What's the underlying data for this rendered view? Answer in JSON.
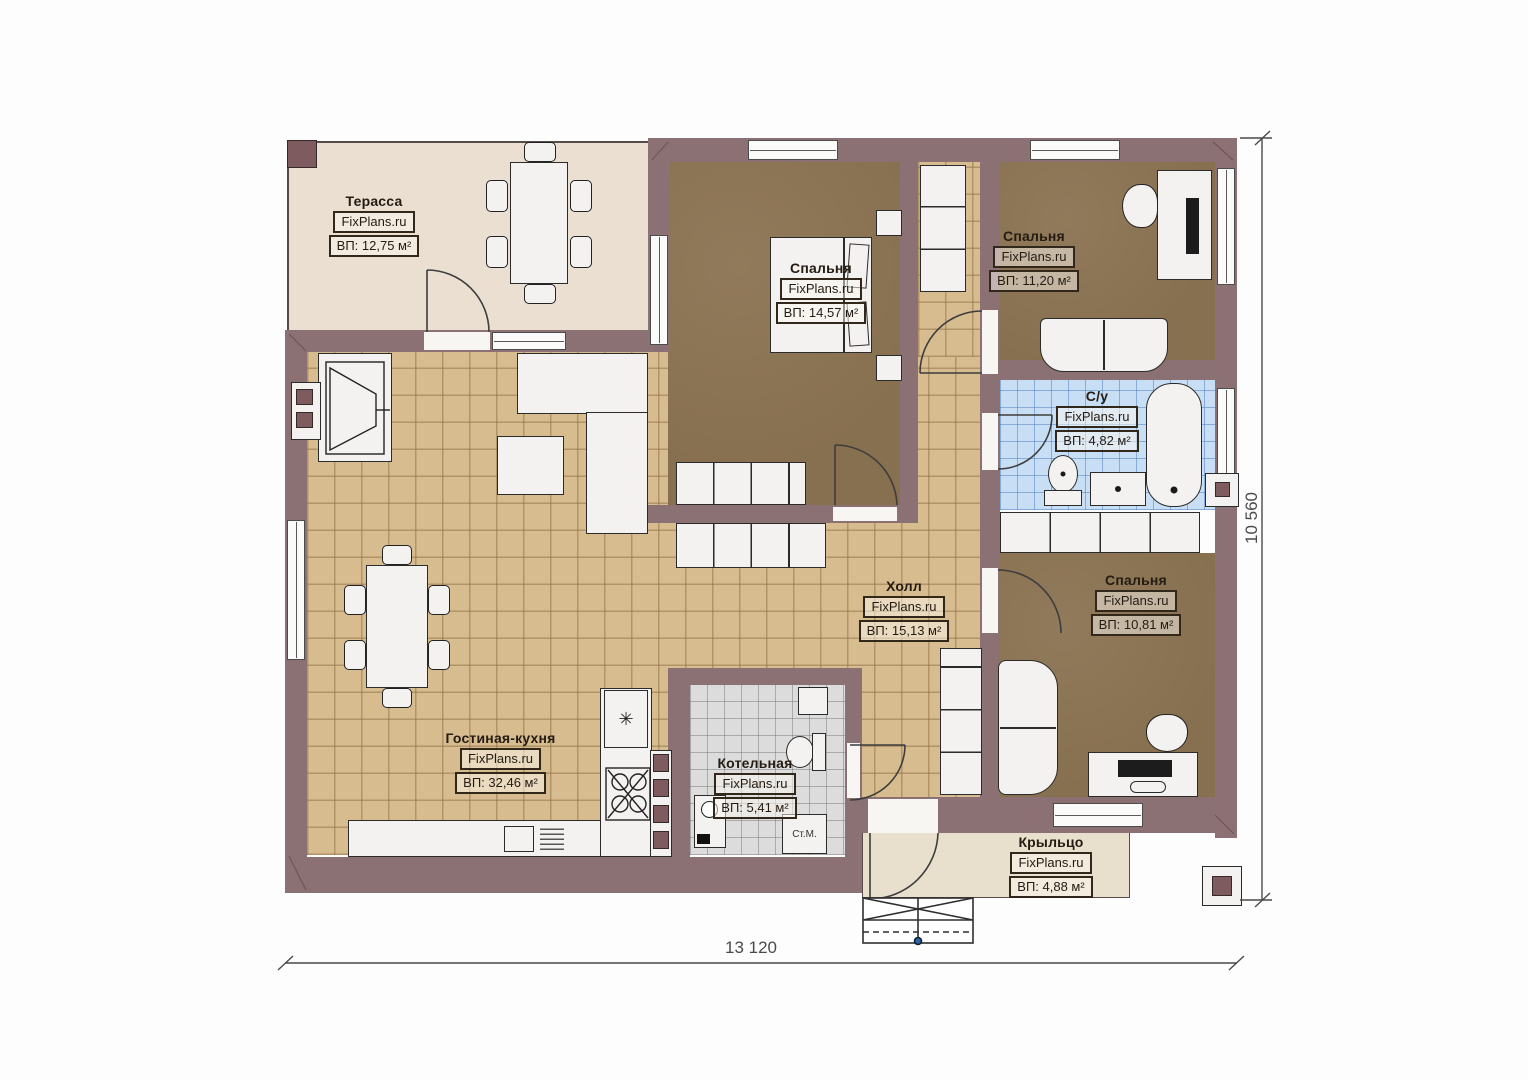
{
  "plan": {
    "title": "Floor plan",
    "rooms": [
      {
        "name": "Терасса",
        "watermark": "FixPlans.ru",
        "area": "ВП: 12,75 м²"
      },
      {
        "name": "Спальня",
        "watermark": "FixPlans.ru",
        "area": "ВП: 14,57 м²"
      },
      {
        "name": "Спальня",
        "watermark": "FixPlans.ru",
        "area": "ВП: 11,20 м²"
      },
      {
        "name": "С/у",
        "watermark": "FixPlans.ru",
        "area": "ВП: 4,82 м²"
      },
      {
        "name": "Холл",
        "watermark": "FixPlans.ru",
        "area": "ВП: 15,13 м²"
      },
      {
        "name": "Спальня",
        "watermark": "FixPlans.ru",
        "area": "ВП: 10,81 м²"
      },
      {
        "name": "Гостиная-кухня",
        "watermark": "FixPlans.ru",
        "area": "ВП: 32,46 м²"
      },
      {
        "name": "Котельная",
        "watermark": "FixPlans.ru",
        "area": "ВП: 5,41 м²"
      },
      {
        "name": "Крыльцо",
        "watermark": "FixPlans.ru",
        "area": "ВП: 4,88 м²"
      }
    ],
    "dimensions": {
      "width": "13 120",
      "height": "10 560"
    },
    "appliances": {
      "washing_machine": "Ст.М.",
      "fridge_symbol": "✳"
    },
    "colors": {
      "wall": "#8b7173",
      "terrace": "#eadfd1",
      "porch": "#e8dfcc",
      "tile": "#d7bc90",
      "bedroom": "#8c7557",
      "bath": "#c8def5",
      "boiler": "#dcdcdc"
    }
  }
}
